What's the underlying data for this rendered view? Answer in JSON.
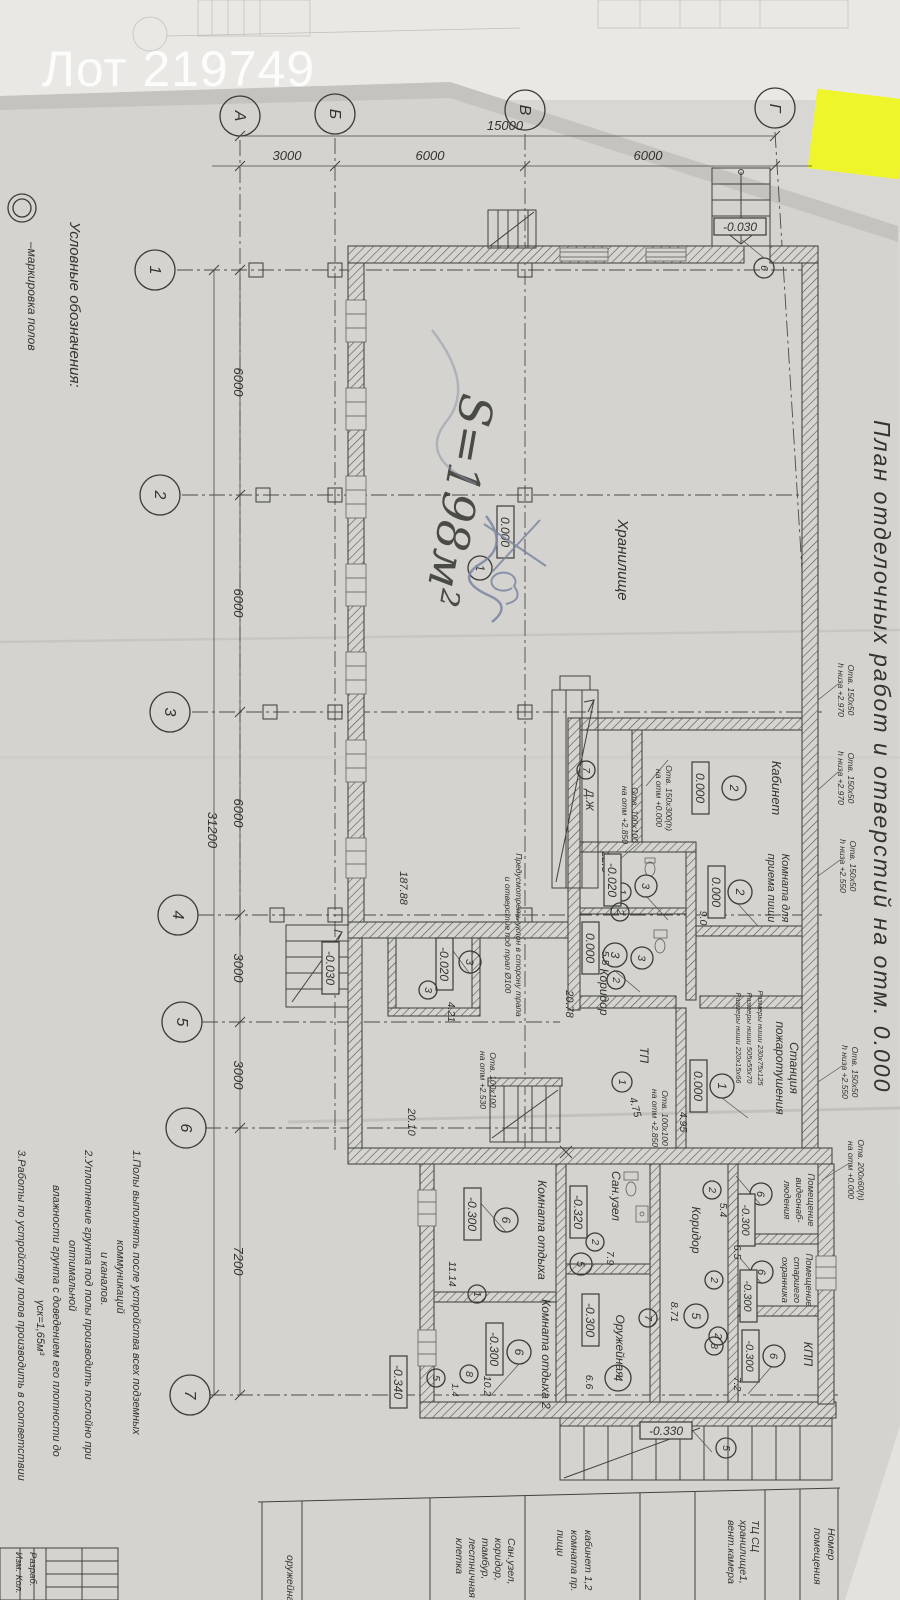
{
  "header": {
    "lot_label": "Лот 219749"
  },
  "colors": {
    "pen": "#7d86a2",
    "sticky": "#eef62b",
    "paper": "#d5d4d0",
    "ink": "#34342e"
  },
  "drawing_title": "План отделочных работ и отверстий на отм. 0.000",
  "legend": {
    "heading": "Условные обозначения:",
    "item_floor_mark": "–маркировка полов"
  },
  "grid": {
    "top_axes": [
      "А",
      "Б",
      "В",
      "Г"
    ],
    "left_axes": [
      "1",
      "2",
      "3",
      "4",
      "5",
      "6",
      "7"
    ],
    "dim_total_top": "15000",
    "dim_top_segments": [
      "3000",
      "6000",
      "6000"
    ],
    "dim_total_left": "31200",
    "dim_left_segments": [
      "6000",
      "6000",
      "6000",
      "3000",
      "3000",
      "7200"
    ]
  },
  "handwriting": {
    "area": "S=198м²"
  },
  "rooms": [
    {
      "name_lines": [
        "Хранилище"
      ],
      "floor_mark": "1",
      "level": "0.000",
      "area": "187.88"
    },
    {
      "name_lines": [
        "Кабинет"
      ],
      "floor_mark": "2",
      "level": "0.000",
      "area": "22.5"
    },
    {
      "name_lines": [
        "Комната для",
        "приема пищи"
      ],
      "floor_mark": "2",
      "level": "0.000",
      "area": "9.0"
    },
    {
      "floor_mark": "3",
      "level": "-0.020",
      "area": "5.5"
    },
    {
      "name_lines": [
        "Коридор"
      ],
      "floor_mark": "3",
      "level": "0.000",
      "area": "20.78"
    },
    {
      "floor_mark": "3",
      "level": "-0.020",
      "area": "4.21"
    },
    {
      "name_lines": [
        "Станция",
        "пожаротушения"
      ],
      "floor_mark": "1",
      "level": "0.000",
      "area": "4.95"
    },
    {
      "name_lines": [
        "ТП"
      ],
      "floor_mark": "1",
      "area": "4.75"
    },
    {
      "name_lines": [
        "Комната отдыха"
      ],
      "floor_mark": "6",
      "level": "-0.300",
      "area": "11.14"
    },
    {
      "name_lines": [
        "Комната отдыха 2"
      ],
      "floor_mark": "6",
      "level": "-0.300",
      "area": "10.2"
    },
    {
      "name_lines": [
        "Сан.узел"
      ],
      "floor_mark": "5",
      "level": "-0.320",
      "area": "7.9"
    },
    {
      "name_lines": [
        "Коридор"
      ],
      "floor_mark": "5",
      "area": "8.71"
    },
    {
      "name_lines": [
        "Оружейная"
      ],
      "floor_mark": "4",
      "level": "-0.300",
      "area": "6.6"
    },
    {
      "name_lines": [
        "Помещение",
        "видеонаб-",
        "людения"
      ],
      "floor_mark": "6",
      "level": "-0.300",
      "area": "5.4"
    },
    {
      "name_lines": [
        "Помещение",
        "старшего",
        "охранника"
      ],
      "floor_mark": "6",
      "level": "-0.300",
      "area": "6.5"
    },
    {
      "name_lines": [
        "КПП"
      ],
      "floor_mark": "6",
      "level": "-0.300",
      "area": "7.2"
    }
  ],
  "marks": {
    "dj": "Д.Ж",
    "sub_area": "20.10",
    "tambour_area": "1.4",
    "entry_level": "-0.030",
    "porch_level": "-0.330",
    "out_level": "-0.340"
  },
  "opening_marks": {
    "m1": "1",
    "m2": "2",
    "m3": "3",
    "m5": "5",
    "m6": "6",
    "m7": "7",
    "m8": "8"
  },
  "annotations": {
    "right": [
      {
        "l1": "Отв. 150х50",
        "l2": "h низа +2.970"
      },
      {
        "l1": "Отв. 150х50",
        "l2": "h низа +2.970"
      },
      {
        "l1": "Отв. 150х50",
        "l2": "h низа +2.550"
      },
      {
        "l1": "Отв. 150х50",
        "l2": "h низа +2.550"
      },
      {
        "l1": "Отв. 200х60(h)",
        "l2": "на отм +0.000"
      }
    ],
    "inner": [
      {
        "l1": "Отв. 100х100",
        "l2": "на отм +2.850"
      },
      {
        "l1": "Отв. 150х300(h)",
        "l2": "на отм +0.000"
      },
      {
        "l1": "Отв. 100х100",
        "l2": "на отм +2.530"
      },
      {
        "l1": "Отв. 100х100",
        "l2": "на отм +2.850"
      }
    ],
    "niches": [
      "Размеры ниши 230х75х125",
      "Размеры ниши 505х55х70",
      "Размеры ниши 220х15х66"
    ],
    "slope_lines": [
      "Предусмотреть уклон в сторону трапа",
      "и отверстие под трап Ø100"
    ]
  },
  "notes_lines": [
    "1.Полы выполнять после устройства всех подземных",
    "коммуникаций",
    "и каналов.",
    "2.Уплотнение грунта под полы производить послойно при",
    "оптимальной",
    "влажности грунта с доведением его плотности до",
    "γск=1,65м³",
    "3.Работы по устройству полов производить в соответствии"
  ],
  "schedule": {
    "header_lines": [
      "Номер",
      "помещения"
    ],
    "rows": [
      {
        "lines": [
          "ТЦ СЦ",
          "хранилище1,",
          "вент.камера"
        ]
      },
      {
        "lines": [
          "кабинет 1,2",
          "комната пр.",
          "пищи"
        ]
      },
      {
        "lines": [
          "Сан.узел,",
          "коридор,",
          "тамбур,",
          "лестничная",
          "клетка"
        ]
      },
      {
        "lines": [
          "оружейная"
        ]
      }
    ]
  },
  "titleblock": {
    "col1": "Изм. Кол.",
    "col2": "Разраб."
  }
}
